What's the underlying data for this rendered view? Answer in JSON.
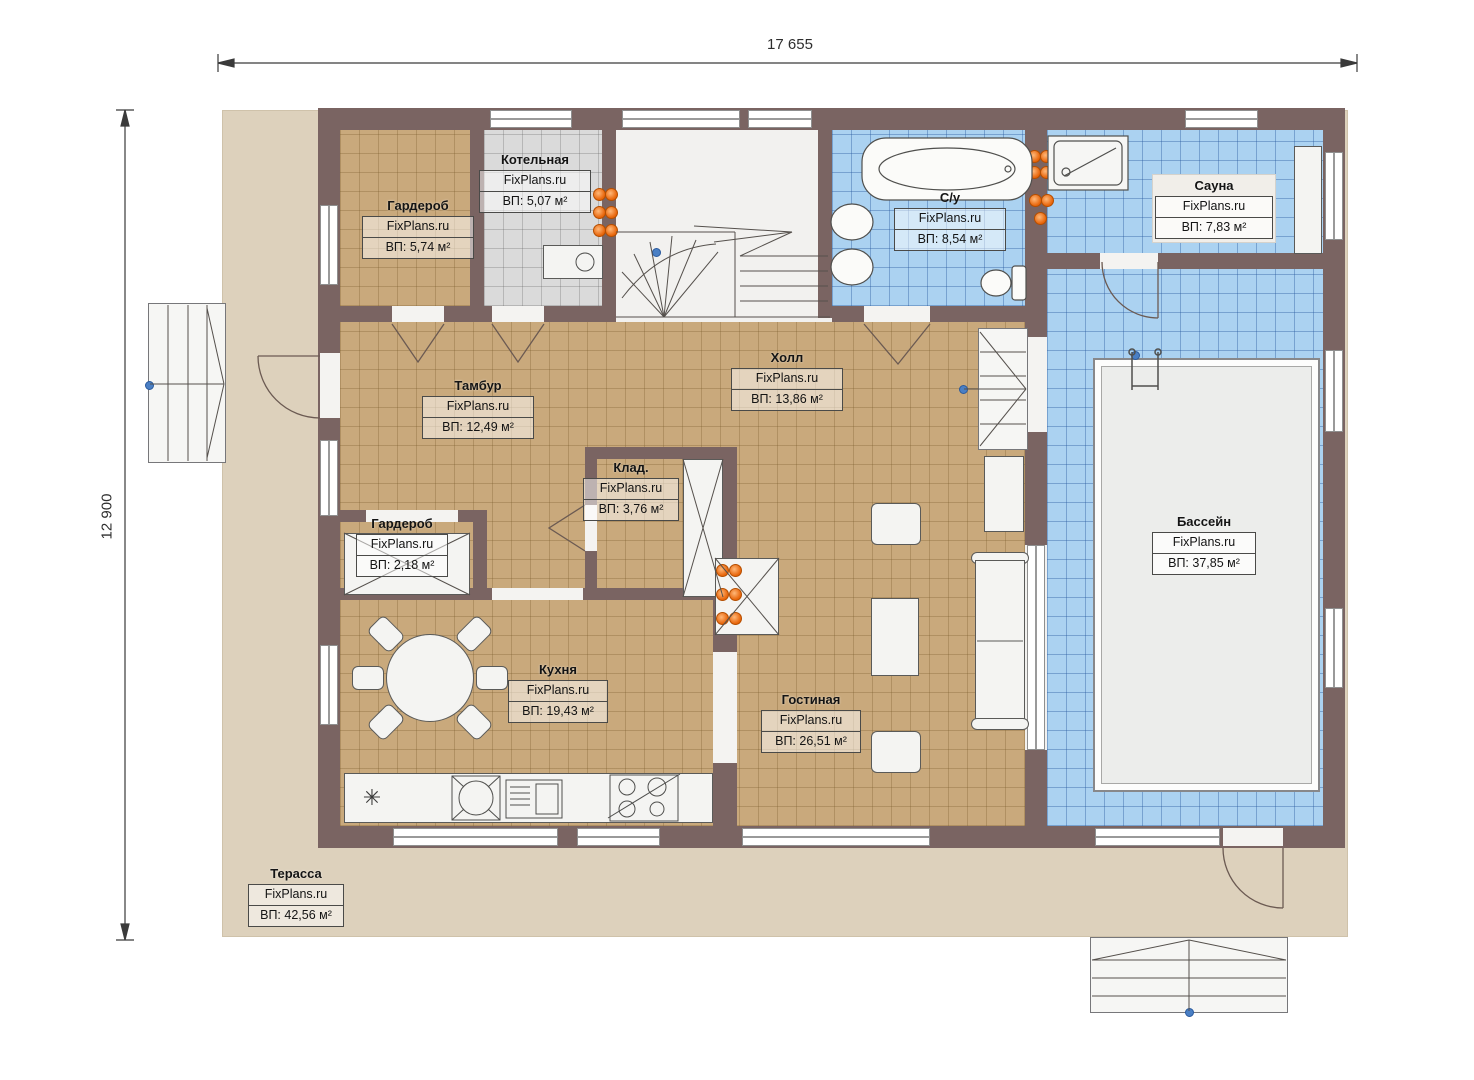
{
  "site": "FixPlans.ru",
  "dimensions": {
    "width_label": "17 655",
    "height_label": "12 900"
  },
  "rooms": {
    "garderob1": {
      "name": "Гардероб",
      "area": "ВП: 5,74 м²"
    },
    "kotelnaya": {
      "name": "Котельная",
      "area": "ВП: 5,07 м²"
    },
    "su": {
      "name": "С/у",
      "area": "ВП: 8,54 м²"
    },
    "sauna": {
      "name": "Сауна",
      "area": "ВП: 7,83 м²"
    },
    "tambur": {
      "name": "Тамбур",
      "area": "ВП: 12,49 м²"
    },
    "holl": {
      "name": "Холл",
      "area": "ВП: 13,86 м²"
    },
    "klad": {
      "name": "Клад.",
      "area": "ВП: 3,76 м²"
    },
    "garderob2": {
      "name": "Гардероб",
      "area": "ВП: 2,18 м²"
    },
    "bassein": {
      "name": "Бассейн",
      "area": "ВП: 37,85 м²"
    },
    "kuhnya": {
      "name": "Кухня",
      "area": "ВП: 19,43 м²"
    },
    "gostinaya": {
      "name": "Гостиная",
      "area": "ВП: 26,51 м²"
    },
    "terrassa": {
      "name": "Терасса",
      "area": "ВП: 42,56 м²"
    }
  },
  "icons": {
    "fridge": "✳"
  },
  "colors": {
    "wall": "#7a6462",
    "floor_tan": "#c9a97c",
    "floor_blue": "#abd2f1",
    "floor_gray": "#dadada",
    "terrace": "#ddd1bc",
    "radiator_orange": "#e8650a",
    "node_blue": "#4a7fc4"
  }
}
